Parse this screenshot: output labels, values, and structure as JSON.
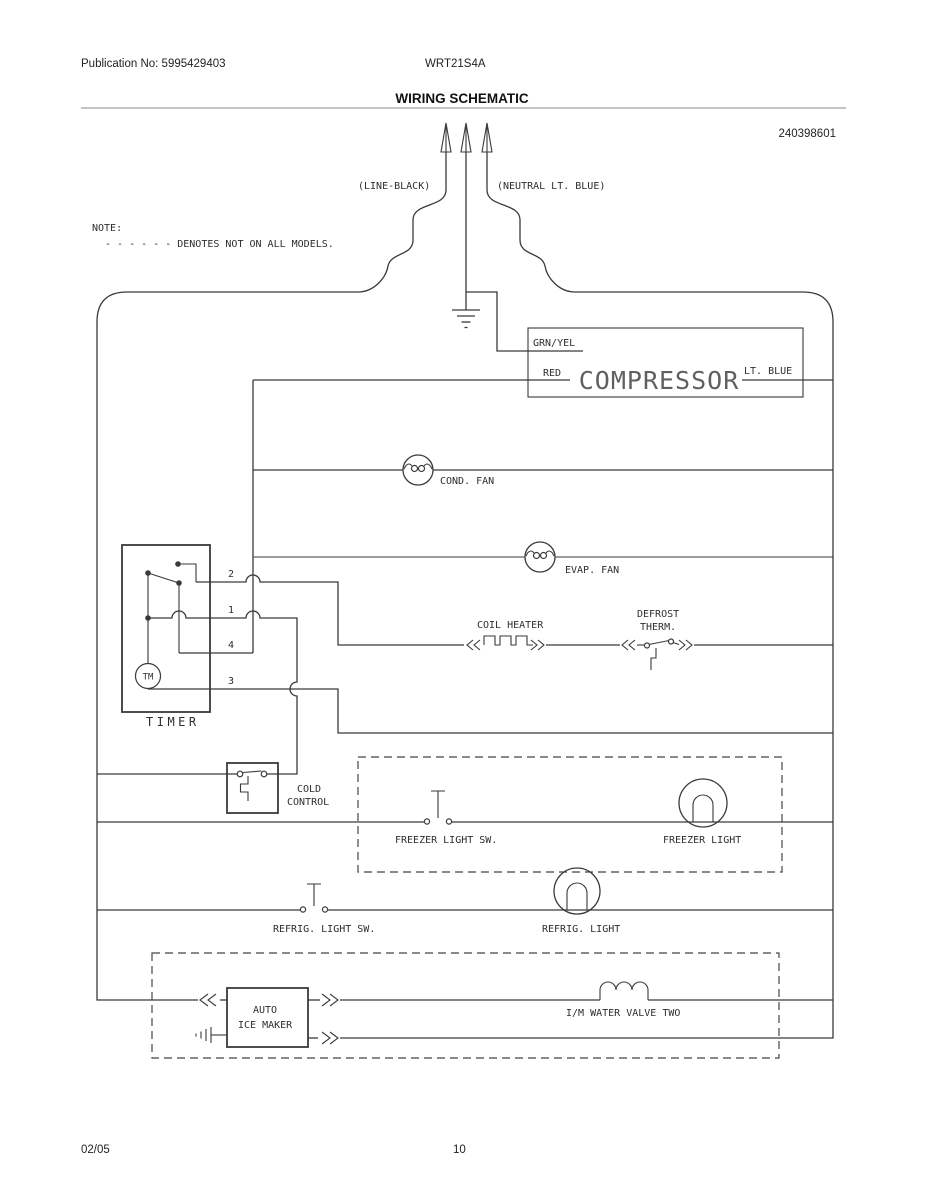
{
  "page": {
    "publication": "Publication No: 5995429403",
    "model": "WRT21S4A",
    "title": "WIRING SCHEMATIC",
    "part_number": "240398601",
    "footer_date": "02/05",
    "footer_page": "10"
  },
  "note": {
    "label": "NOTE:",
    "text": "- - - - - - DENOTES NOT ON ALL MODELS."
  },
  "plug": {
    "line_label": "(LINE-BLACK)",
    "neutral_label": "(NEUTRAL LT. BLUE)"
  },
  "compressor": {
    "name": "COMPRESSOR",
    "grn_yel": "GRN/YEL",
    "red": "RED",
    "lt_blue": "LT. BLUE"
  },
  "components": {
    "cond_fan": "COND. FAN",
    "evap_fan": "EVAP. FAN",
    "coil_heater": "COIL HEATER",
    "defrost1": "DEFROST",
    "defrost2": "THERM."
  },
  "timer": {
    "label": "TIMER",
    "motor": "TM",
    "t2": "2",
    "t1": "1",
    "t4": "4",
    "t3": "3"
  },
  "cold_control": {
    "line1": "COLD",
    "line2": "CONTROL"
  },
  "lights": {
    "freezer_sw": "FREEZER LIGHT SW.",
    "freezer": "FREEZER LIGHT",
    "refrig_sw": "REFRIG. LIGHT SW.",
    "refrig": "REFRIG. LIGHT"
  },
  "icemaker": {
    "line1": "AUTO",
    "line2": "ICE MAKER",
    "water_valve": "I/M WATER VALVE TWO"
  }
}
